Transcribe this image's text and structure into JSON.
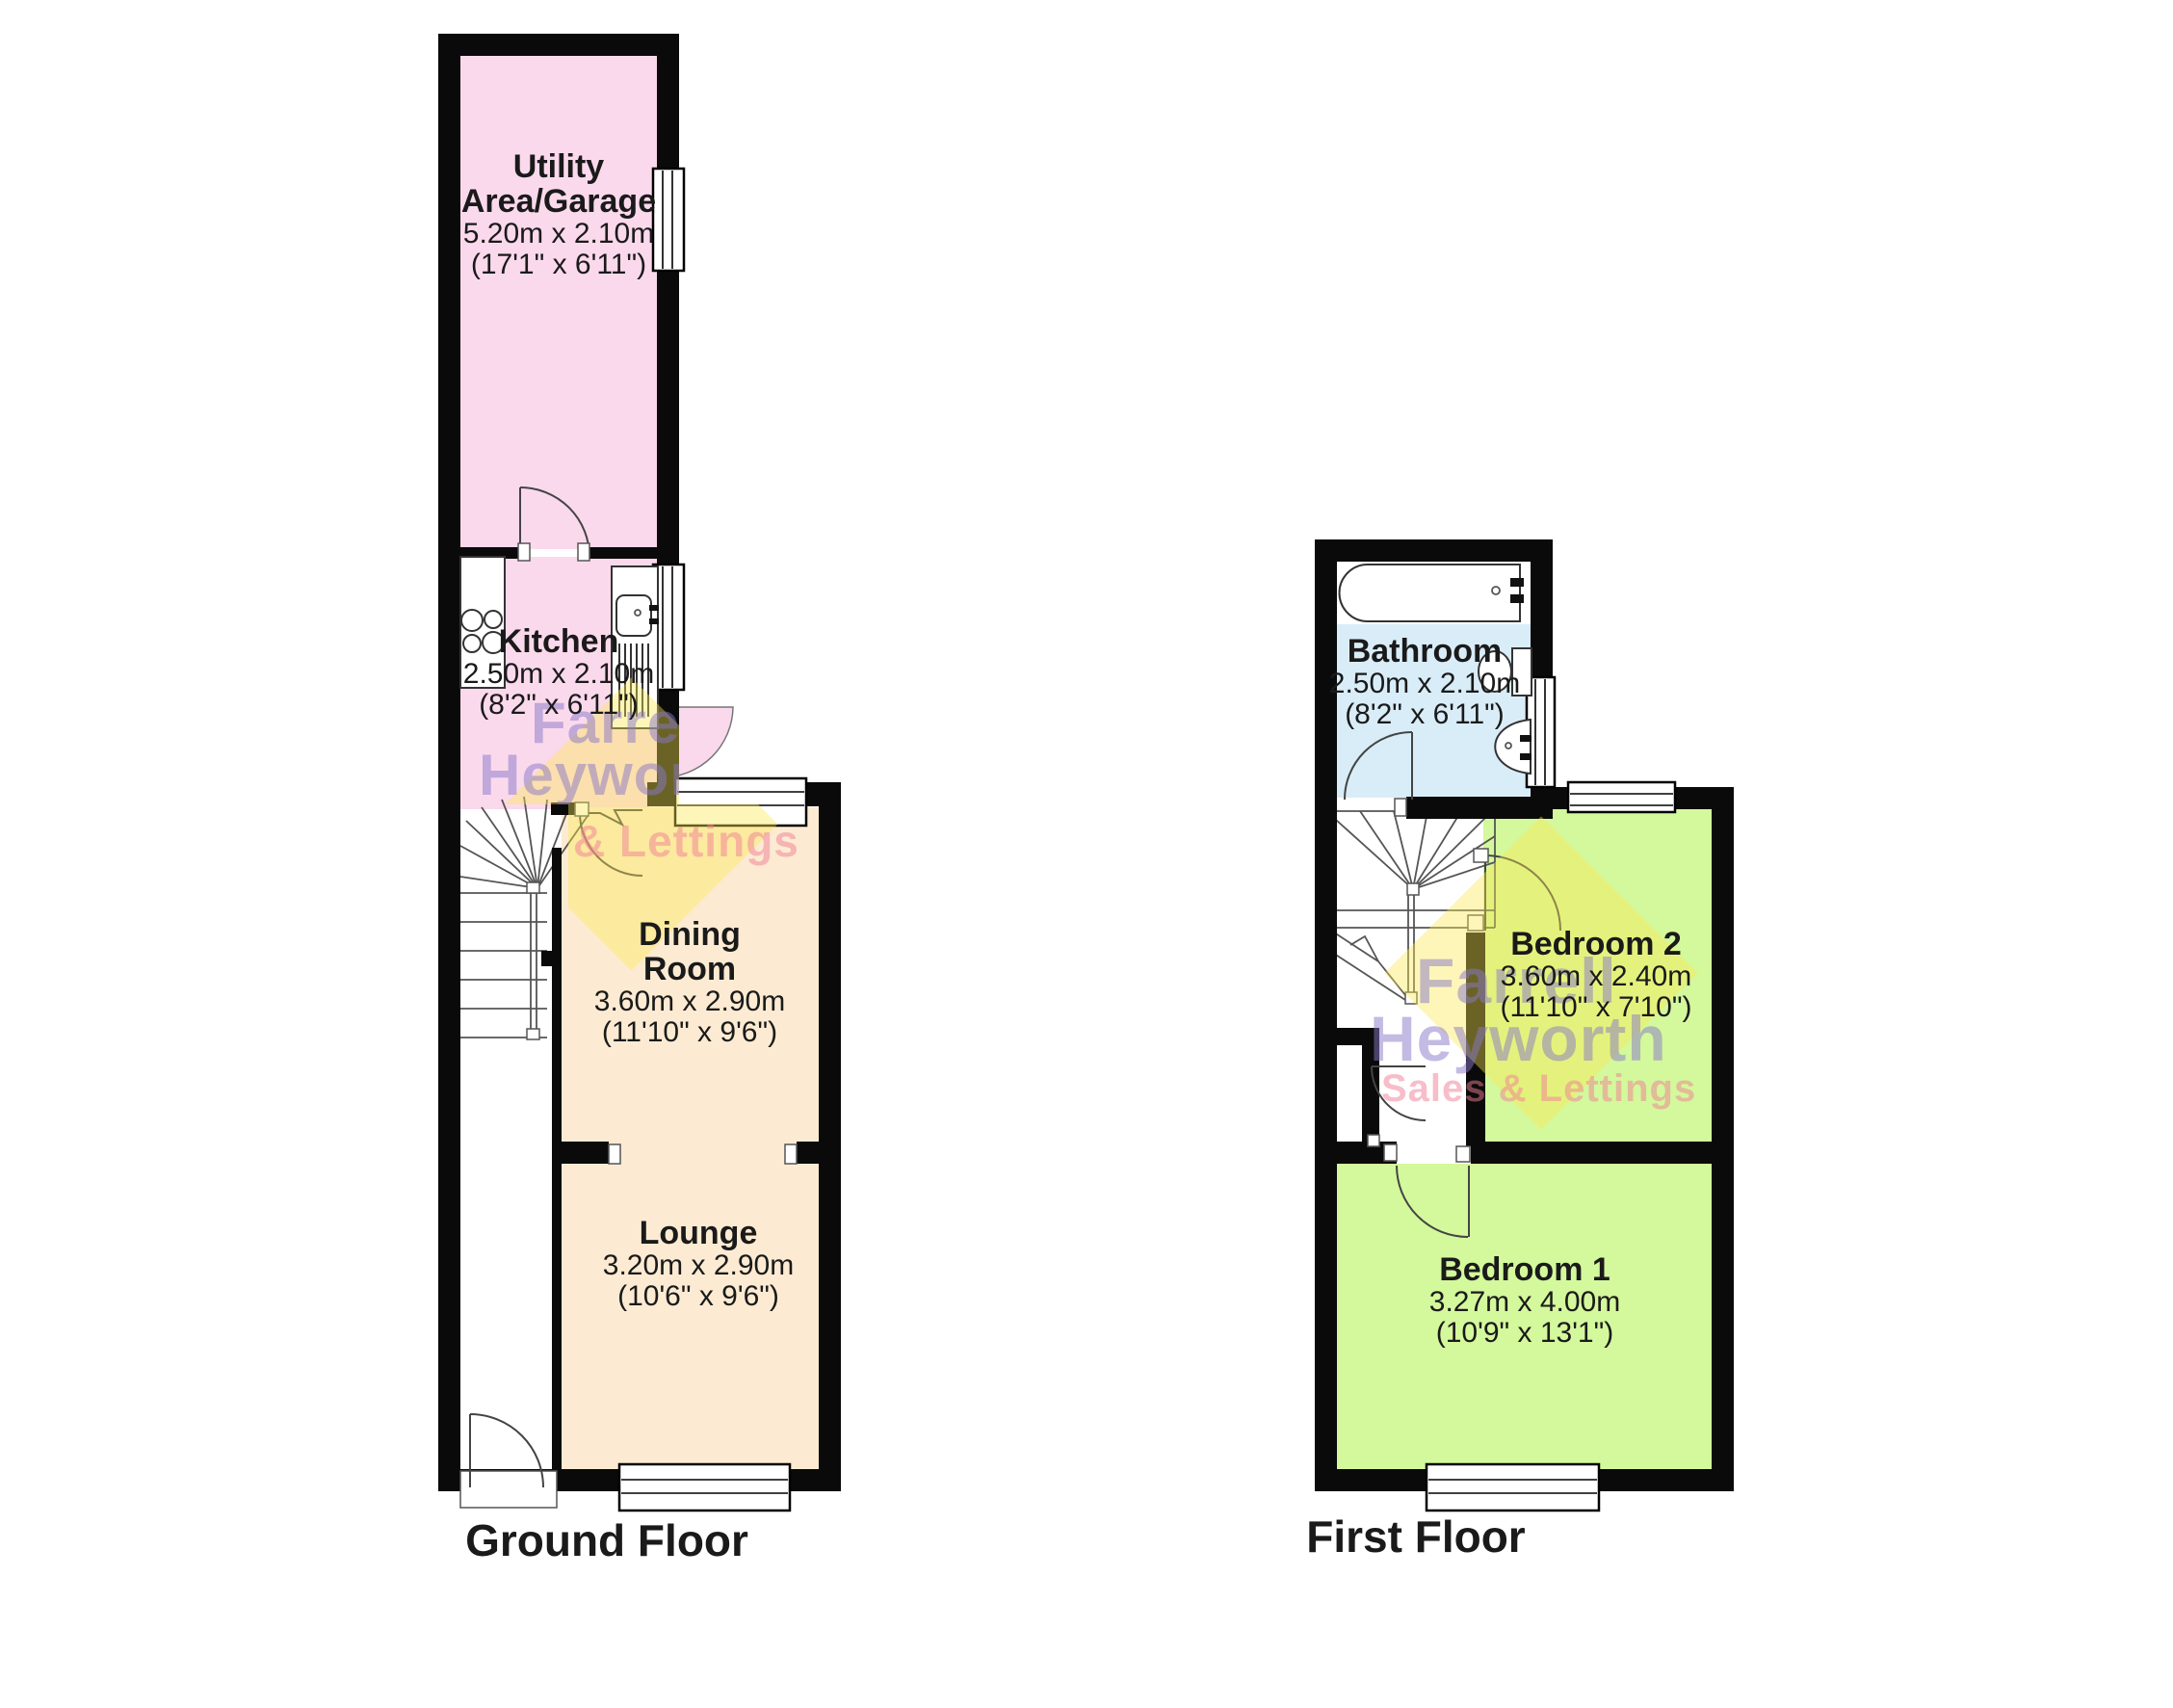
{
  "colors": {
    "wall": "#0a0a0a",
    "room_pink": "#FBD9EC",
    "room_cream": "#FCEBD2",
    "room_blue": "#D9EDF8",
    "room_green": "#D4F89C",
    "wm_purple": "rgba(135,120,200,0.50)",
    "wm_pink": "rgba(240,125,150,0.50)",
    "wm_yellow": "rgba(252,232,80,0.40)"
  },
  "watermark": {
    "line1": "Farrell",
    "line2": "Heyworth",
    "line3": "Sales & Lettings"
  },
  "floors": [
    {
      "id": "ground",
      "label": "Ground Floor",
      "rooms": [
        {
          "id": "utility-area-garage",
          "name": "Utility Area/Garage",
          "dimensions_m": "5.20m x 2.10m",
          "dimensions_ft": "(17'1\" x 6'11\")"
        },
        {
          "id": "kitchen",
          "name": "Kitchen",
          "dimensions_m": "2.50m x 2.10m",
          "dimensions_ft": "(8'2\" x 6'11\")"
        },
        {
          "id": "dining-room",
          "name": "Dining Room",
          "dimensions_m": "3.60m x 2.90m",
          "dimensions_ft": "(11'10\" x 9'6\")"
        },
        {
          "id": "lounge",
          "name": "Lounge",
          "dimensions_m": "3.20m x 2.90m",
          "dimensions_ft": "(10'6\" x 9'6\")"
        }
      ]
    },
    {
      "id": "first",
      "label": "First Floor",
      "rooms": [
        {
          "id": "bathroom",
          "name": "Bathroom",
          "dimensions_m": "2.50m x 2.10m",
          "dimensions_ft": "(8'2\" x 6'11\")"
        },
        {
          "id": "bedroom-2",
          "name": "Bedroom 2",
          "dimensions_m": "3.60m x 2.40m",
          "dimensions_ft": "(11'10\" x 7'10\")"
        },
        {
          "id": "bedroom-1",
          "name": "Bedroom 1",
          "dimensions_m": "3.27m x 4.00m",
          "dimensions_ft": "(10'9\" x 13'1\")"
        }
      ]
    }
  ]
}
